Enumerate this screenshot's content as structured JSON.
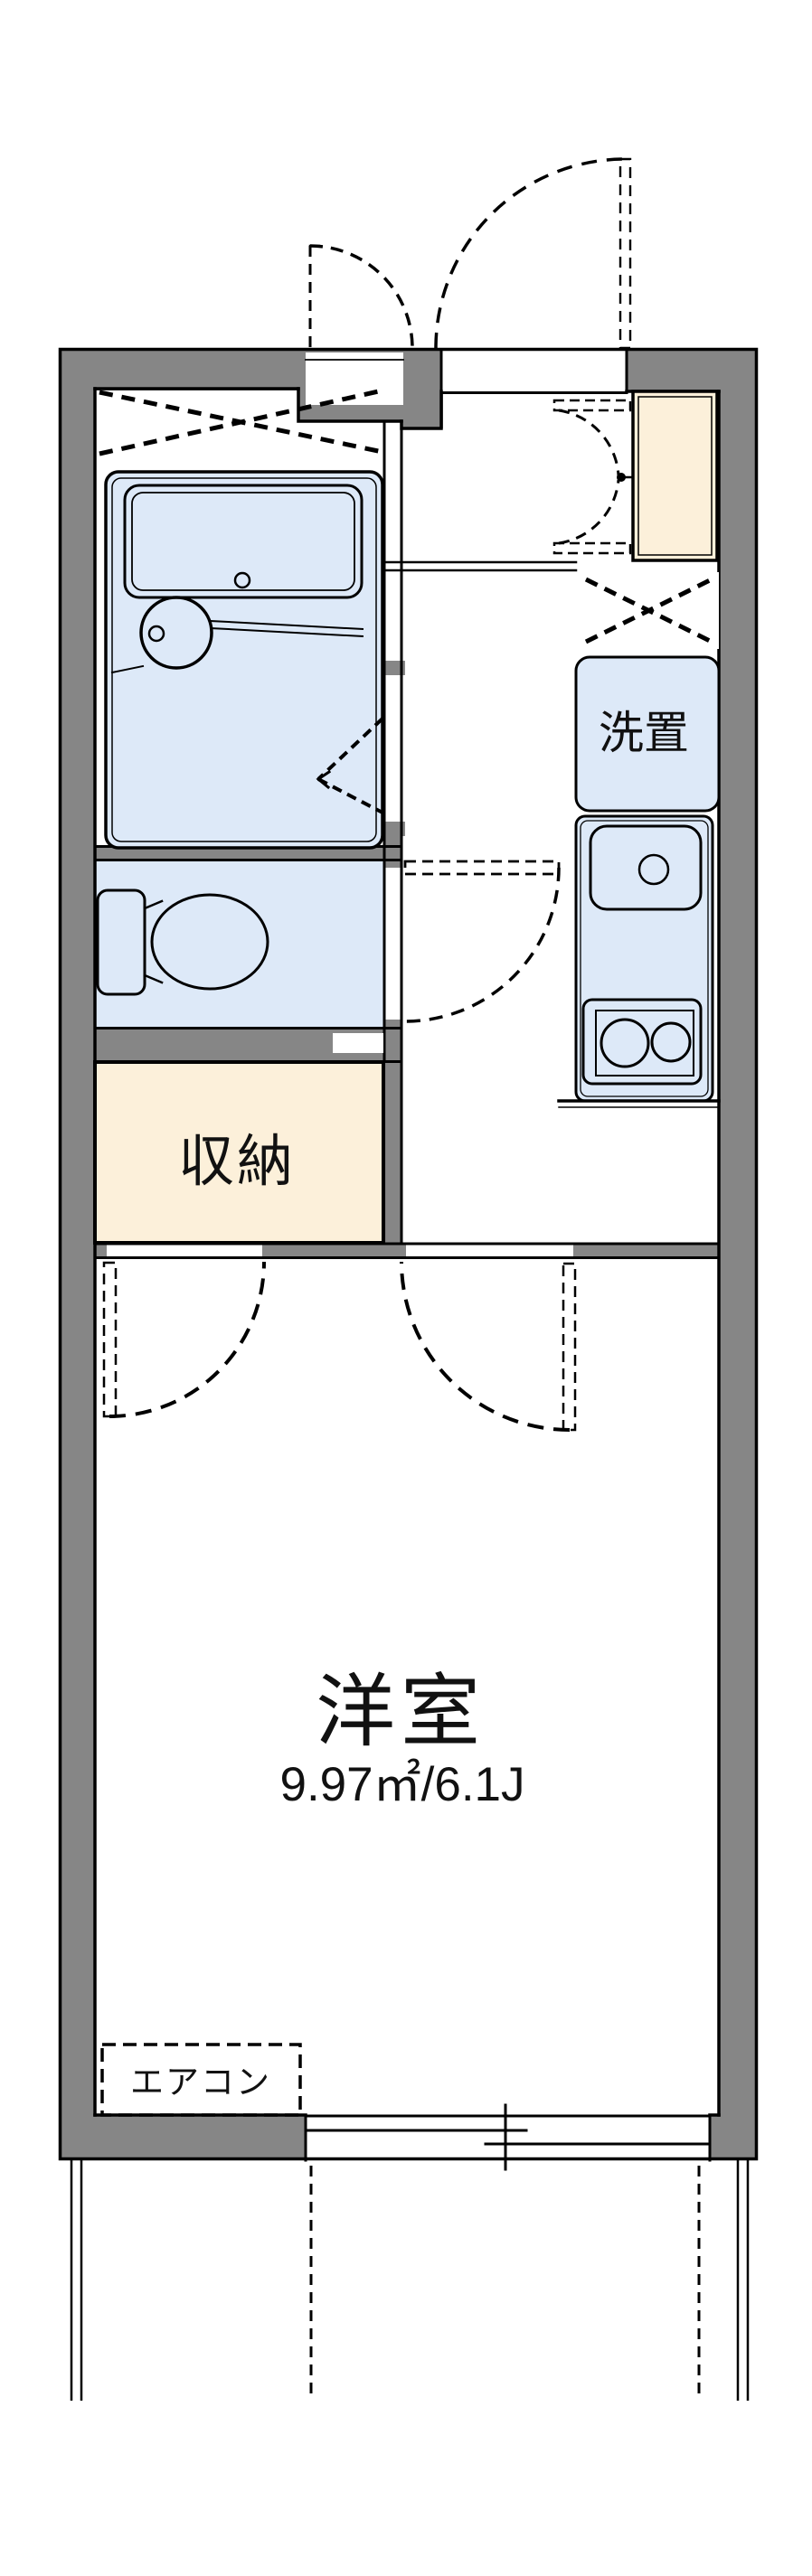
{
  "labels": {
    "laundry": "洗置",
    "storage": "収納",
    "room_name": "洋室",
    "room_area": "9.97㎡/6.1J",
    "aircon": "エアコン"
  },
  "colors": {
    "wall": "#868686",
    "blue": "#dde9f8",
    "beige": "#fcf0da",
    "line": "#000000",
    "bg": "#ffffff"
  }
}
